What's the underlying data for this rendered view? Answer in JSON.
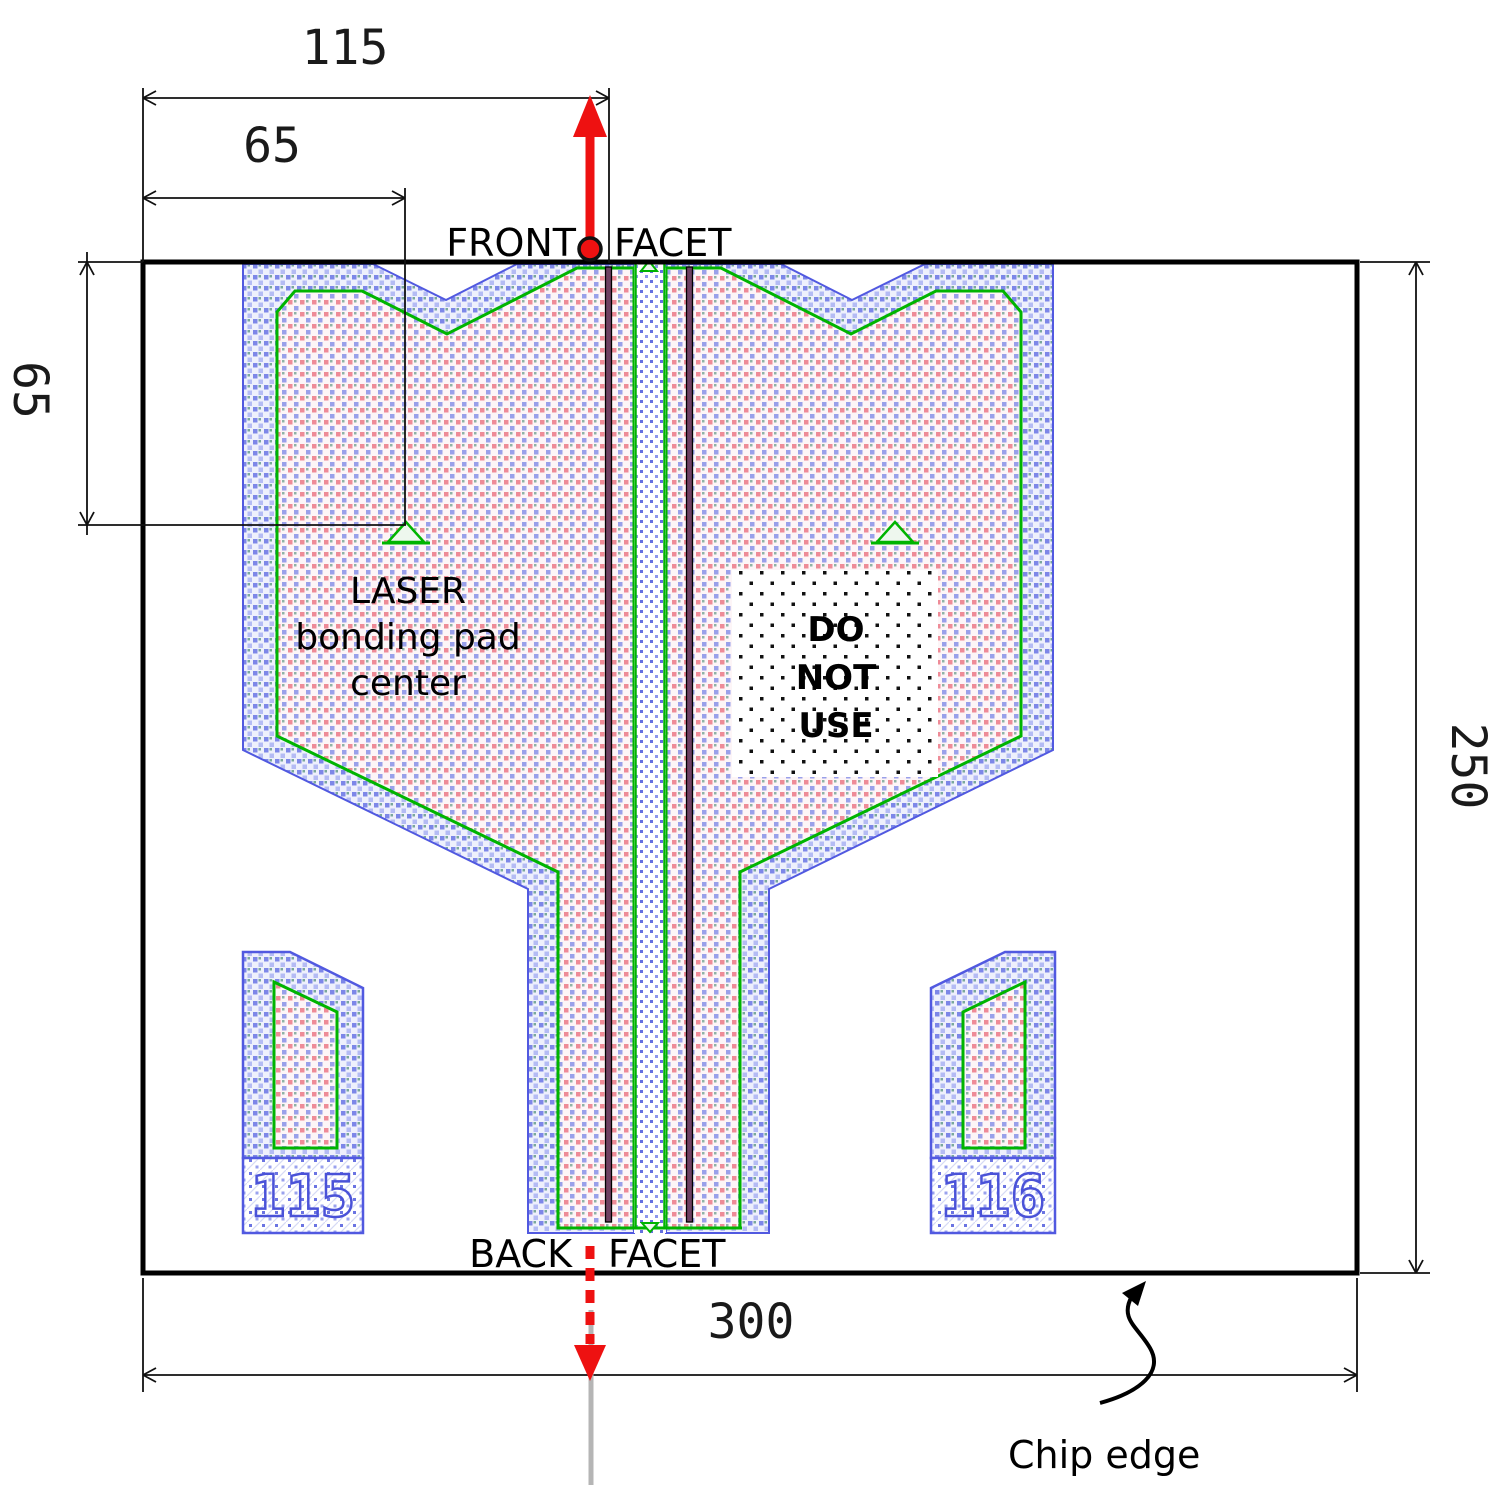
{
  "labels": {
    "front_facet_word1": "FRONT",
    "front_facet_word2": "FACET",
    "back_facet_word1": "BACK",
    "back_facet_word2": "FACET",
    "laser_pad_line1": "LASER",
    "laser_pad_line2": "bonding pad",
    "laser_pad_line3": "center",
    "do_not_use_line1": "DO",
    "do_not_use_line2": "NOT",
    "do_not_use_line3": "USE",
    "chip_edge": "Chip edge",
    "left_pad_number": "115",
    "right_pad_number": "116"
  },
  "dimensions": {
    "facet_to_ridge": "115",
    "pad_center_x": "65",
    "pad_center_y": "65",
    "chip_width": "300",
    "chip_height": "250"
  },
  "colors": {
    "facet_marker_red": "#ee1111",
    "pad_outline_green": "#00b400",
    "pad_border_blue": "#5159e0",
    "chip_outline_black": "#000000",
    "emission_axis_gray": "#b5b5b5"
  }
}
